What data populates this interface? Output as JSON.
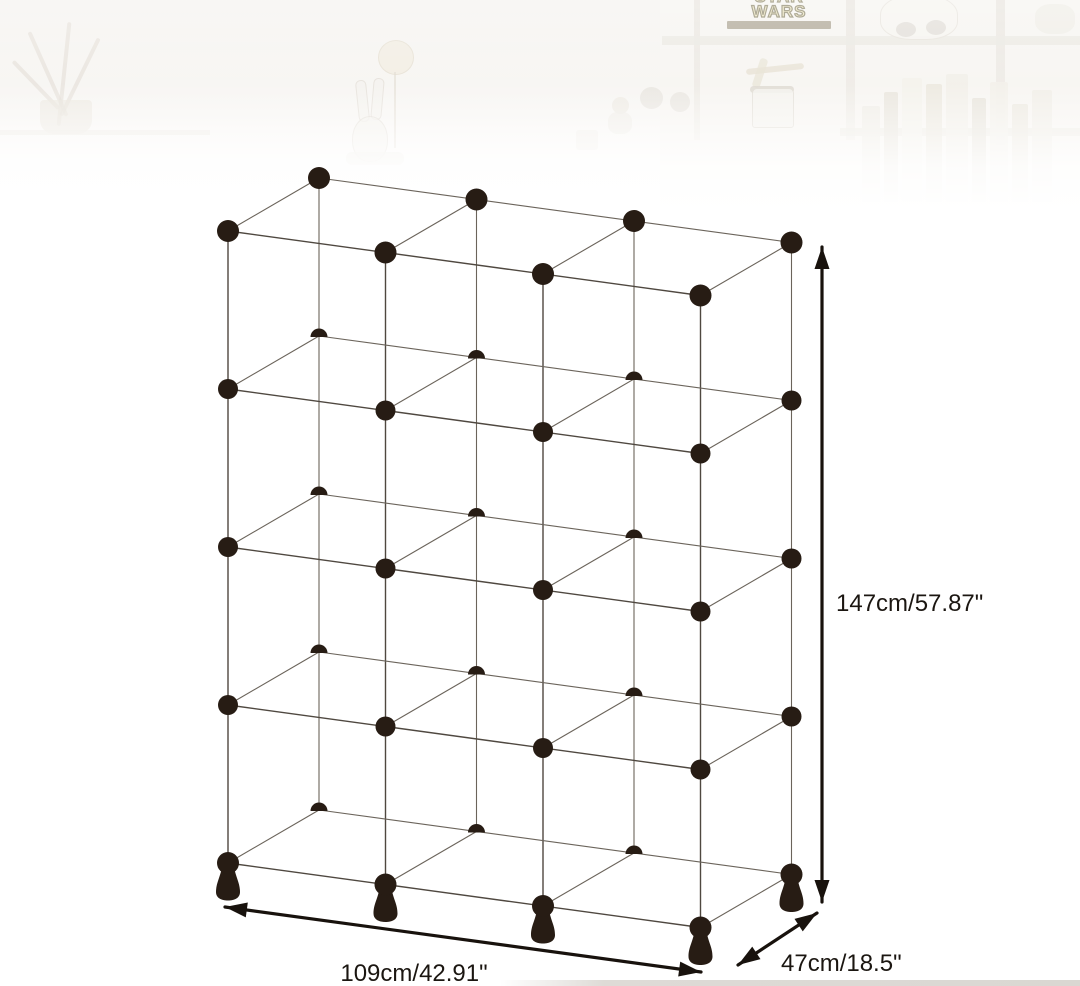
{
  "image": {
    "description": "Dimension diagram of a 12-cube (3 columns x 4 rows) modular cube storage organizer drawn as a wireframe with black ball connectors and pawn-shaped feet, over a faded product-photo banner",
    "width_px": 1080,
    "height_px": 986
  },
  "dimensions": {
    "height": {
      "text": "147cm/57.87\""
    },
    "width": {
      "text": "109cm/42.91\""
    },
    "depth": {
      "text": "47cm/18.5\""
    }
  },
  "figure": {
    "type": "dimension-diagram",
    "grid": {
      "columns": 3,
      "rows": 4,
      "depth_cubes": 1
    },
    "projection": {
      "origin": [
        228,
        863
      ],
      "col_vec": [
        157.5,
        21.5
      ],
      "row_vec": [
        0,
        -158
      ],
      "depth_vec": [
        91,
        -53
      ]
    },
    "style": {
      "front_line_color": "#4f4840",
      "back_line_color": "#6b645b",
      "ball_color": "#271c14",
      "arrow_color": "#18120d",
      "label_color": "#1b1611"
    },
    "arrows": {
      "height": {
        "from": [
          822,
          247
        ],
        "to": [
          822,
          902
        ]
      },
      "width": {
        "from": [
          225,
          907
        ],
        "to": [
          701,
          972
        ]
      },
      "depth": {
        "from": [
          738,
          965
        ],
        "to": [
          817,
          913
        ]
      }
    }
  },
  "background_banner": {
    "sign": {
      "line1": "STAR",
      "line2": "WARS"
    }
  }
}
